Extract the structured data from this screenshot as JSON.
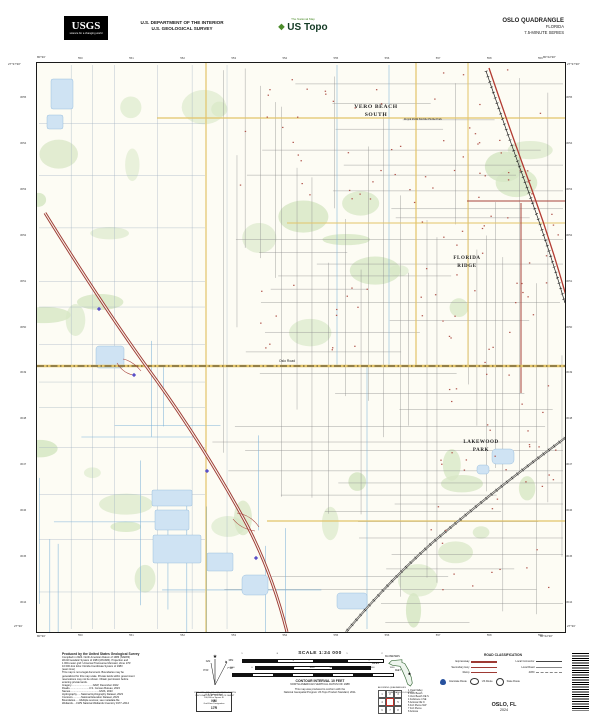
{
  "header": {
    "agency_logo": "USGS",
    "agency_tagline": "science for a changing world",
    "dept_line1": "U.S. DEPARTMENT OF THE INTERIOR",
    "dept_line2": "U.S. GEOLOGICAL SURVEY",
    "brand_tagline": "The National Map",
    "brand_name": "US Topo",
    "quad_name": "OSLO QUADRANGLE",
    "quad_state": "FLORIDA",
    "quad_series": "7.5-MINUTE SERIES"
  },
  "map": {
    "corner_nw_lon": "80°30'",
    "corner_nw_lat": "27°37'30\"",
    "corner_ne_lon": "80°22'30\"",
    "corner_ne_lat": "27°37'30\"",
    "corner_sw_lon": "80°30'",
    "corner_sw_lat": "27°30'",
    "corner_se_lon": "80°22'30\"",
    "corner_se_lat": "27°30'",
    "grid_top": [
      "550",
      "551",
      "552",
      "553",
      "554",
      "555",
      "556",
      "557",
      "558",
      "559"
    ],
    "grid_left": [
      "3055",
      "3054",
      "3053",
      "3052",
      "3051",
      "3050",
      "3049",
      "3048",
      "3047",
      "3046",
      "3045",
      "3044"
    ],
    "labels": {
      "place1a": "VERO BEACH",
      "place1b": "SOUTH",
      "place2": "Royal Palm Mobile Home Park",
      "place3a": "FLORIDA",
      "place3b": "RIDGE",
      "place4a": "LAKEWOOD",
      "place4b": "PARK",
      "road1": "Oslo Road"
    }
  },
  "footer": {
    "credits": {
      "title": "Produced by the United States Geological Survey",
      "lines": [
        "Compiled in 2024. North American Datum of 1983 (NAD83)",
        "World Geodetic System of 1984 (WGS84). Projection and",
        "1 000-meter grid: Universal Transverse Mercator, Zone 17R",
        "10 000-foot ticks: Florida Coordinate System of 1983",
        "(east zone)",
        "This map is not a legal document. Boundaries may be",
        "generalized for this map scale. Private lands within government",
        "reservations may not be shown. Obtain permission before",
        "entering private lands."
      ],
      "sources": [
        "Imagery..............................NAIP, December 2022",
        "Roads...........................U.S. Census Bureau, 2023",
        "Names........................................GNIS, 2023",
        "Hydrography......National Hydrography Dataset, 2023",
        "Contours............National Elevation Dataset, 2023",
        "Boundaries......Multiple sources; see metadata file",
        "Wetlands.....FWS National Wetlands Inventory 1977–2014"
      ]
    },
    "declination": {
      "gn_label": "GN",
      "mn_label": "MN",
      "gn_value": "0°21'",
      "mn_value": "7°19'",
      "caption1": "UTM GRID AND 2024 MAGNETIC NORTH",
      "caption2": "DECLINATION AT CENTER OF SHEET",
      "usng_title": "U.S. National Grid",
      "usng_sub": "100,000-m Square ID",
      "usng_square": "NM",
      "usng_zone_label": "Grid Zone Designation",
      "usng_zone": "17R"
    },
    "scale": {
      "title": "SCALE 1:24 000",
      "km_unit": "KILOMETERS",
      "mile_unit": "MILES",
      "feet_unit": "FEET",
      "km_ticks": [
        "1",
        ".5",
        "0",
        "1",
        "2"
      ],
      "mile_ticks": [
        "1",
        ".5",
        "0",
        "1"
      ],
      "feet_ticks": [
        "1000",
        "0",
        "1000",
        "2000",
        "3000",
        "4000",
        "5000",
        "6000",
        "7000"
      ],
      "contour": "CONTOUR INTERVAL 10 FEET",
      "vdatum": "NORTH AMERICAN VERTICAL DATUM OF 1988",
      "conform1": "This map was produced to conform with the",
      "conform2": "National Geospatial Program US Topo Product Standard, 2011."
    },
    "location": {
      "state_caption": "QUADRANGLE LOCATION",
      "adjoining_caption": "ADJOINING QUADRANGLES",
      "adjoining": [
        "Quail Valley",
        "Vero Beach",
        "Vero Beach OE S",
        "Fellsmere 4 SE",
        "Ankona OE N",
        "Fort Pierce NW",
        "Fort Pierce",
        "Ankona"
      ]
    },
    "road_class": {
      "title": "ROAD CLASSIFICATION",
      "col1": [
        "Expressway",
        "Secondary Hwy",
        "Ramp"
      ],
      "col2": [
        "Local Connector",
        "Local Road",
        "4WD"
      ],
      "shields": [
        "Interstate Route",
        "US Route",
        "State Route"
      ]
    },
    "title_block": {
      "name": "OSLO, FL",
      "year": "2024"
    }
  },
  "colors": {
    "expressway": "#9e3a34",
    "secondary": "#a8443c",
    "local_road": "#8d8d8d",
    "water_fill": "#cfe3f3",
    "water_line": "#7fb3d9",
    "vegetation": "#d7e7c5",
    "major_road_fill": "#e3c469",
    "interstate_shield": "#27519e"
  }
}
